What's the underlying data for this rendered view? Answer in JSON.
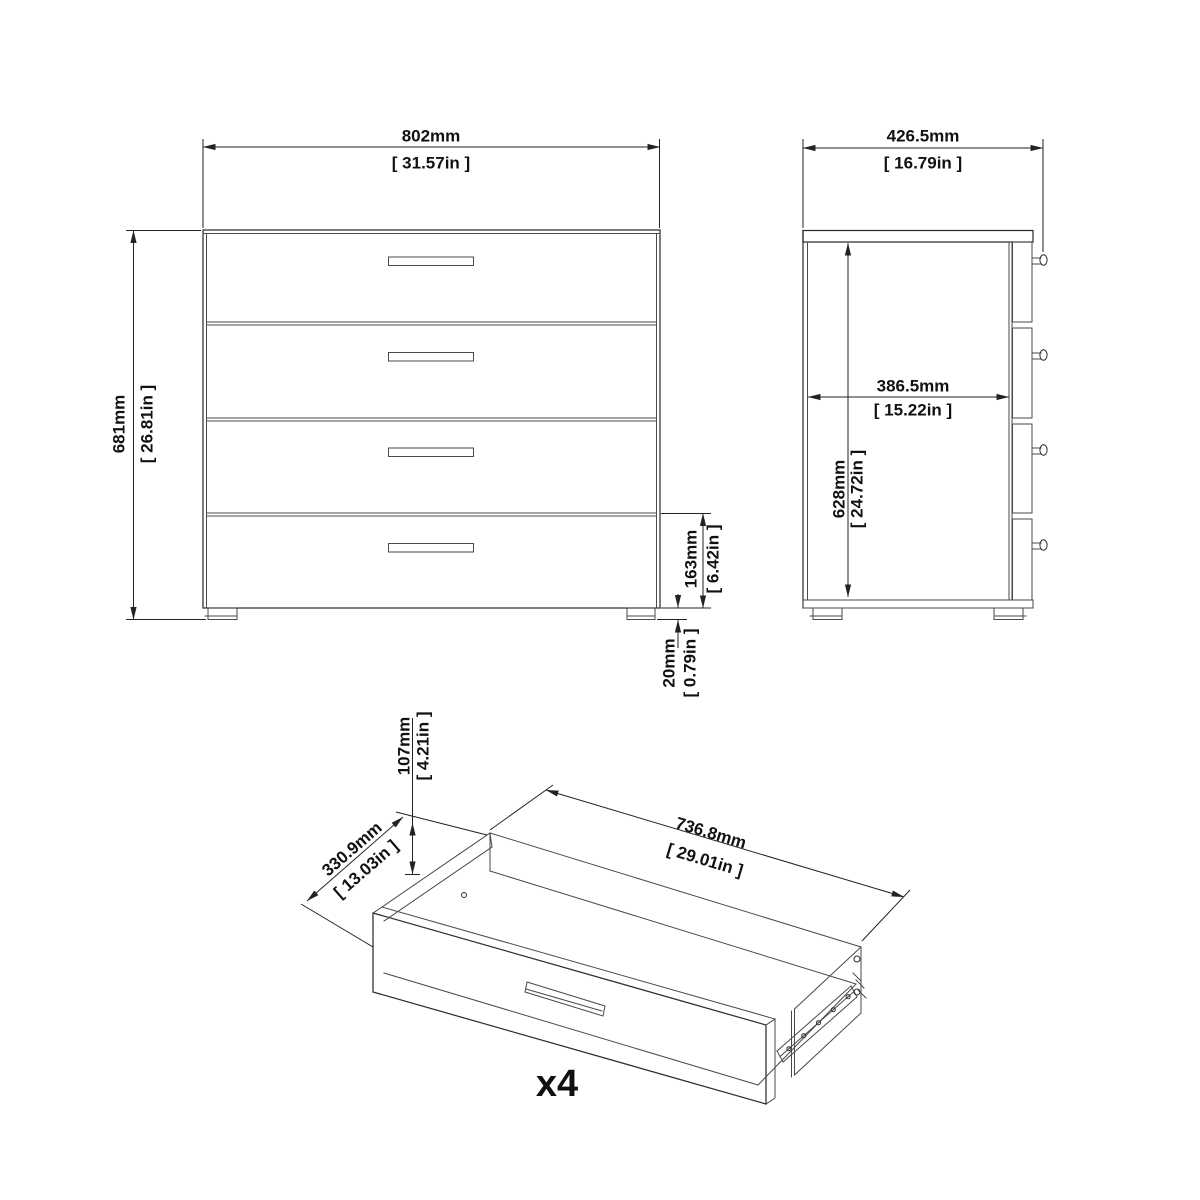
{
  "colors": {
    "line": "#2f2f2f",
    "dimension": "#222222",
    "background": "#ffffff",
    "text": "#111111"
  },
  "front_view": {
    "width_mm": "802mm",
    "width_in": "[ 31.57in ]",
    "height_mm": "681mm",
    "height_in": "[ 26.81in ]",
    "bottom_drawer_mm": "163mm",
    "bottom_drawer_in": "[ 6.42in ]",
    "foot_mm": "20mm",
    "foot_in": "[ 0.79in ]"
  },
  "side_view": {
    "depth_mm": "426.5mm",
    "depth_in": "[ 16.79in ]",
    "inner_depth_mm": "386.5mm",
    "inner_depth_in": "[ 15.22in ]",
    "inner_height_mm": "628mm",
    "inner_height_in": "[ 24.72in ]"
  },
  "drawer_view": {
    "height_mm": "107mm",
    "height_in": "[ 4.21in ]",
    "depth_mm": "330.9mm",
    "depth_in": "[ 13.03in ]",
    "width_mm": "736.8mm",
    "width_in": "[ 29.01in ]",
    "quantity": "x4"
  }
}
